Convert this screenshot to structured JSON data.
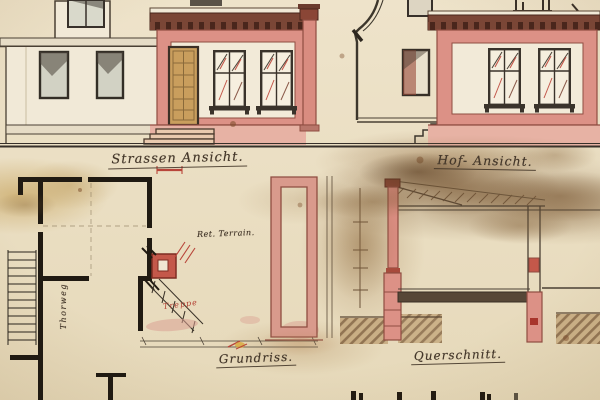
{
  "drawing": {
    "labels": {
      "street_elevation": "Strassen Ansicht.",
      "courtyard_elevation": "Hof- Ansicht.",
      "floor_plan": "Grundriss.",
      "cross_section": "Querschnitt."
    },
    "annotations": {
      "terrain_note": "Ret. Terrain.",
      "stair_note": "Treppe",
      "passage_label": "Thorweg"
    },
    "palette": {
      "paper": "#eadfc6",
      "ink": "#44372a",
      "masonry_pink": "#dc9186",
      "masonry_outline": "#8f4d41",
      "cornice_brown": "#7a4636",
      "door_wood": "#c99e5d",
      "window_glass": "#d2d2c4",
      "plan_wall": "#201a12",
      "accent_red": "#b8453a",
      "ground_brown": "#7d5c3a"
    }
  }
}
